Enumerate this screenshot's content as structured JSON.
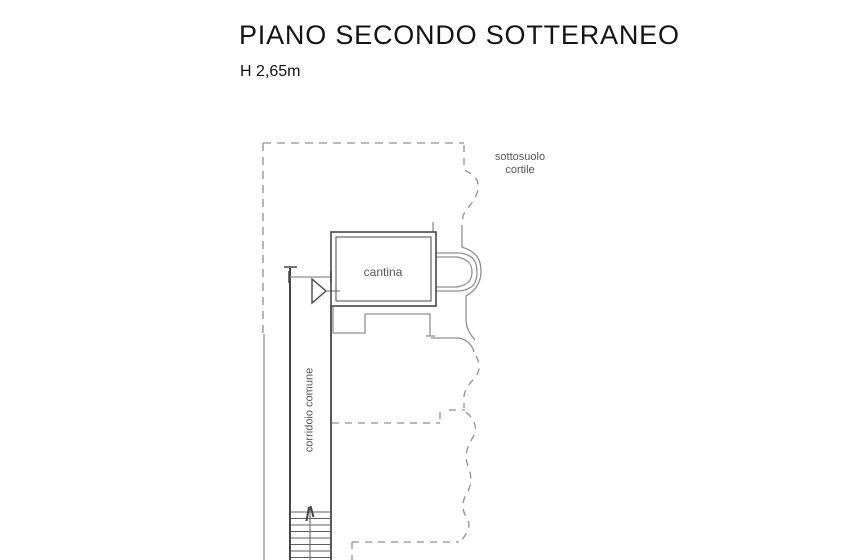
{
  "page": {
    "title": "PIANO SECONDO SOTTERANEO",
    "height_label": "H 2,65m"
  },
  "plan": {
    "labels": {
      "courtyard_line1": "sottosuolo",
      "courtyard_line2": "cortile",
      "room": "cantina",
      "corridor": "corridoio comune"
    },
    "colors": {
      "background": "#ffffff",
      "wall_dark": "#474747",
      "wall_light": "#8f8f8f",
      "stair": "#5f5f5f",
      "label_text": "#565656",
      "title_text": "#141414"
    }
  }
}
